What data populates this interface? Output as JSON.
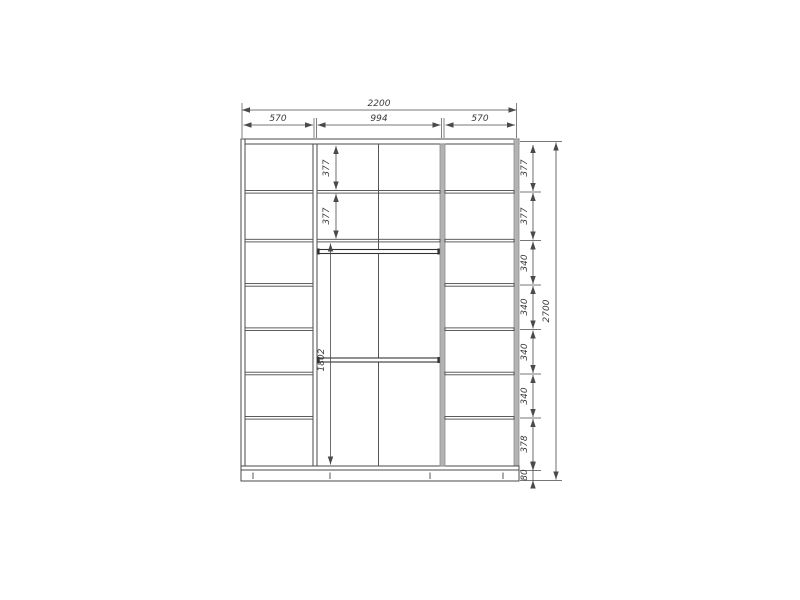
{
  "drawing": {
    "name": "wardrobe-front-dimension-drawing",
    "line_color": "#4a4a4a",
    "panel_gray": "#b3b3b3"
  },
  "dims": {
    "overall_width": "2200",
    "top_sections": [
      "570",
      "994",
      "570"
    ],
    "right_chain": [
      "377",
      "377",
      "340",
      "340",
      "340",
      "340",
      "378",
      "80"
    ],
    "overall_height": "2700",
    "middle_rows": [
      "377",
      "377"
    ],
    "middle_open": "1802"
  }
}
